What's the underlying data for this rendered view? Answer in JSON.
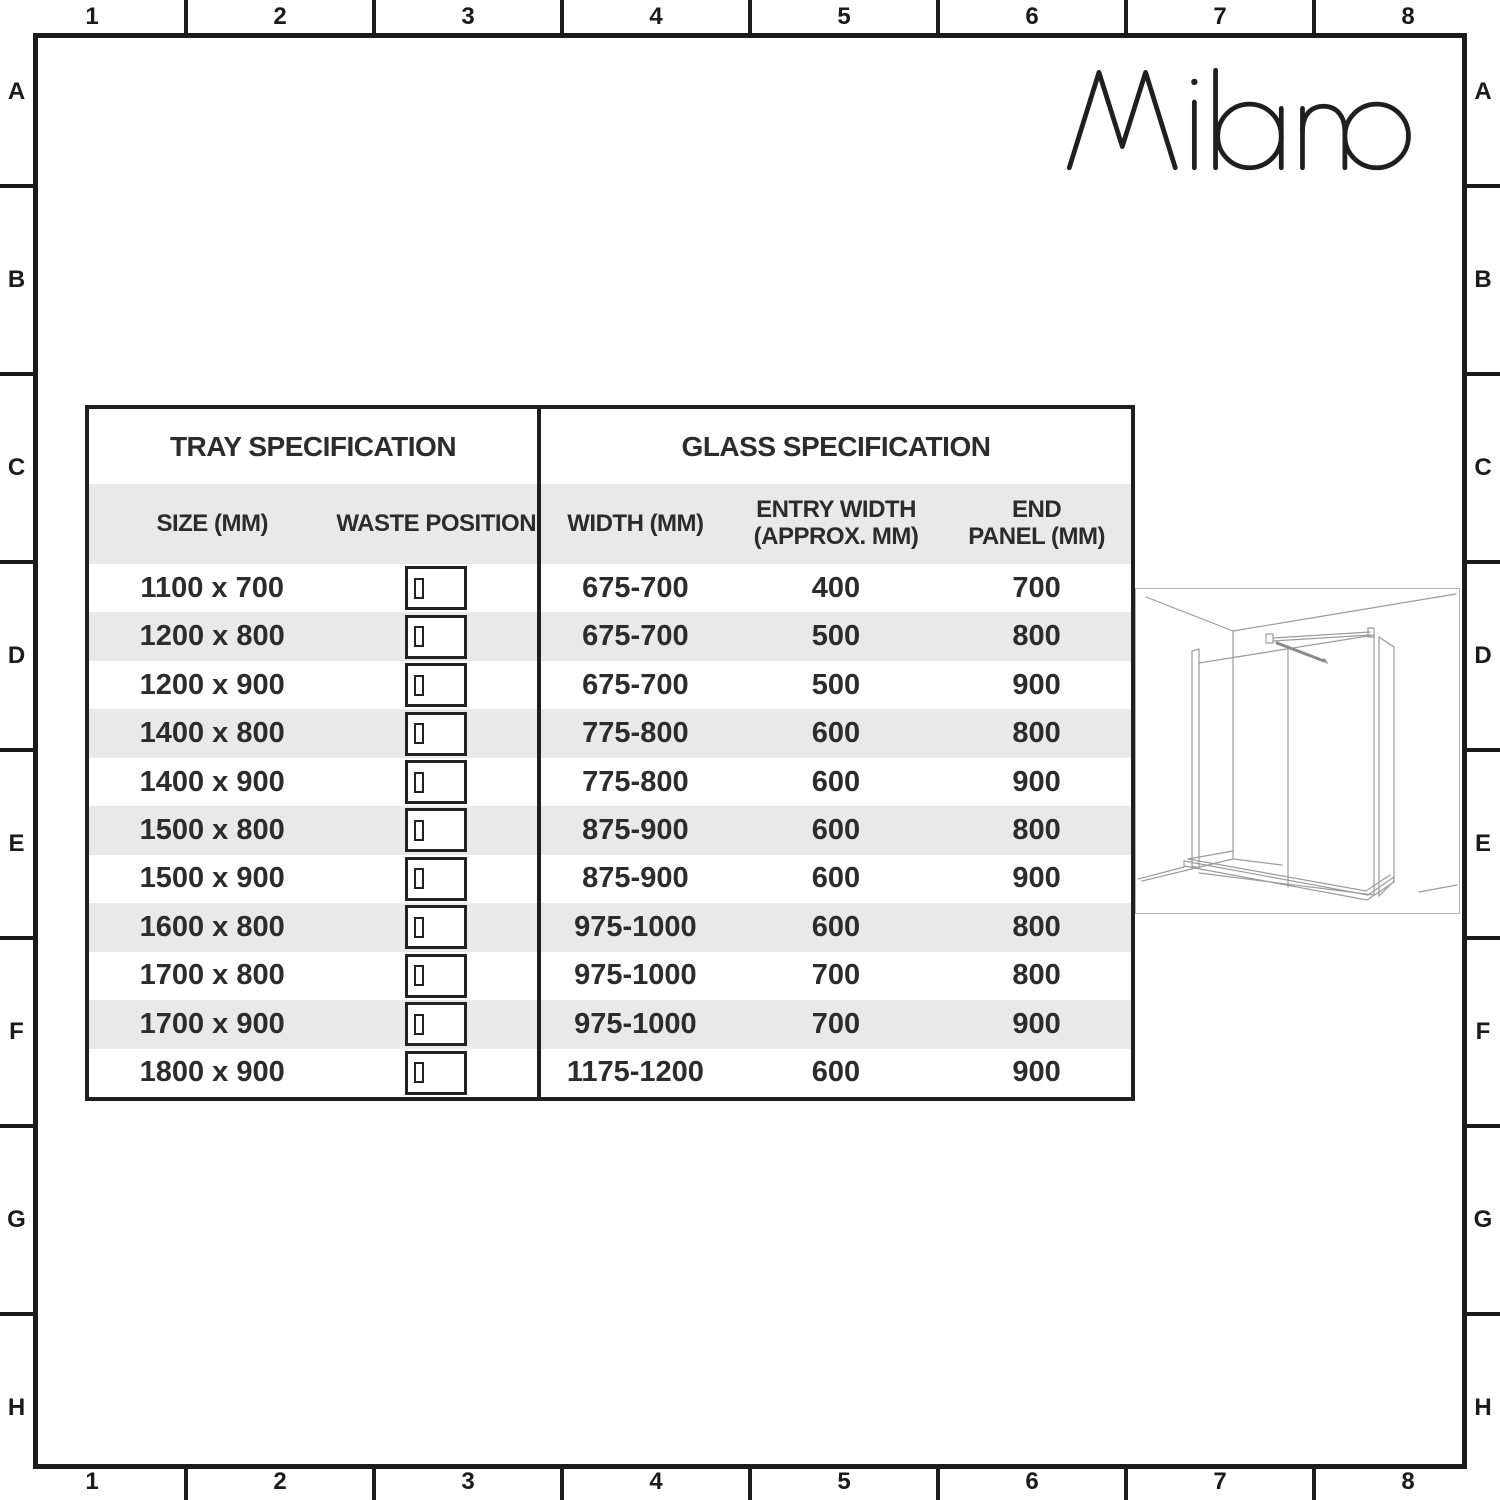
{
  "brand": {
    "logo_text": "Milano"
  },
  "grid": {
    "columns": [
      "1",
      "2",
      "3",
      "4",
      "5",
      "6",
      "7",
      "8"
    ],
    "rows": [
      "A",
      "B",
      "C",
      "D",
      "E",
      "F",
      "G",
      "H"
    ]
  },
  "tray": {
    "title": "TRAY SPECIFICATION",
    "col_size": "SIZE (MM)",
    "col_waste": "WASTE POSITION",
    "waste_icon": "tray-top-view-waste-left-icon",
    "rows": [
      {
        "size": "1100 x 700"
      },
      {
        "size": "1200 x 800"
      },
      {
        "size": "1200 x 900"
      },
      {
        "size": "1400 x 800"
      },
      {
        "size": "1400 x 900"
      },
      {
        "size": "1500 x 800"
      },
      {
        "size": "1500 x 900"
      },
      {
        "size": "1600 x 800"
      },
      {
        "size": "1700 x 800"
      },
      {
        "size": "1700 x 900"
      },
      {
        "size": "1800 x 900"
      }
    ]
  },
  "glass": {
    "title": "GLASS SPECIFICATION",
    "col_width": "WIDTH (MM)",
    "col_entry_line1": "ENTRY WIDTH",
    "col_entry_line2": "(APPROX. MM)",
    "col_end_line1": "END",
    "col_end_line2": "PANEL (MM)",
    "rows": [
      {
        "width": "675-700",
        "entry": "400",
        "end": "700"
      },
      {
        "width": "675-700",
        "entry": "500",
        "end": "800"
      },
      {
        "width": "675-700",
        "entry": "500",
        "end": "900"
      },
      {
        "width": "775-800",
        "entry": "600",
        "end": "800"
      },
      {
        "width": "775-800",
        "entry": "600",
        "end": "900"
      },
      {
        "width": "875-900",
        "entry": "600",
        "end": "800"
      },
      {
        "width": "875-900",
        "entry": "600",
        "end": "900"
      },
      {
        "width": "975-1000",
        "entry": "600",
        "end": "800"
      },
      {
        "width": "975-1000",
        "entry": "700",
        "end": "800"
      },
      {
        "width": "975-1000",
        "entry": "700",
        "end": "900"
      },
      {
        "width": "1175-1200",
        "entry": "600",
        "end": "900"
      }
    ]
  },
  "diagram": {
    "icon": "walk-in-shower-enclosure-line-drawing-icon"
  },
  "colors": {
    "frame_line": "#1b1b1b",
    "row_alt": "#e9e9e9",
    "text": "#2c2c2c",
    "drawing_line": "#9b9b9b"
  }
}
